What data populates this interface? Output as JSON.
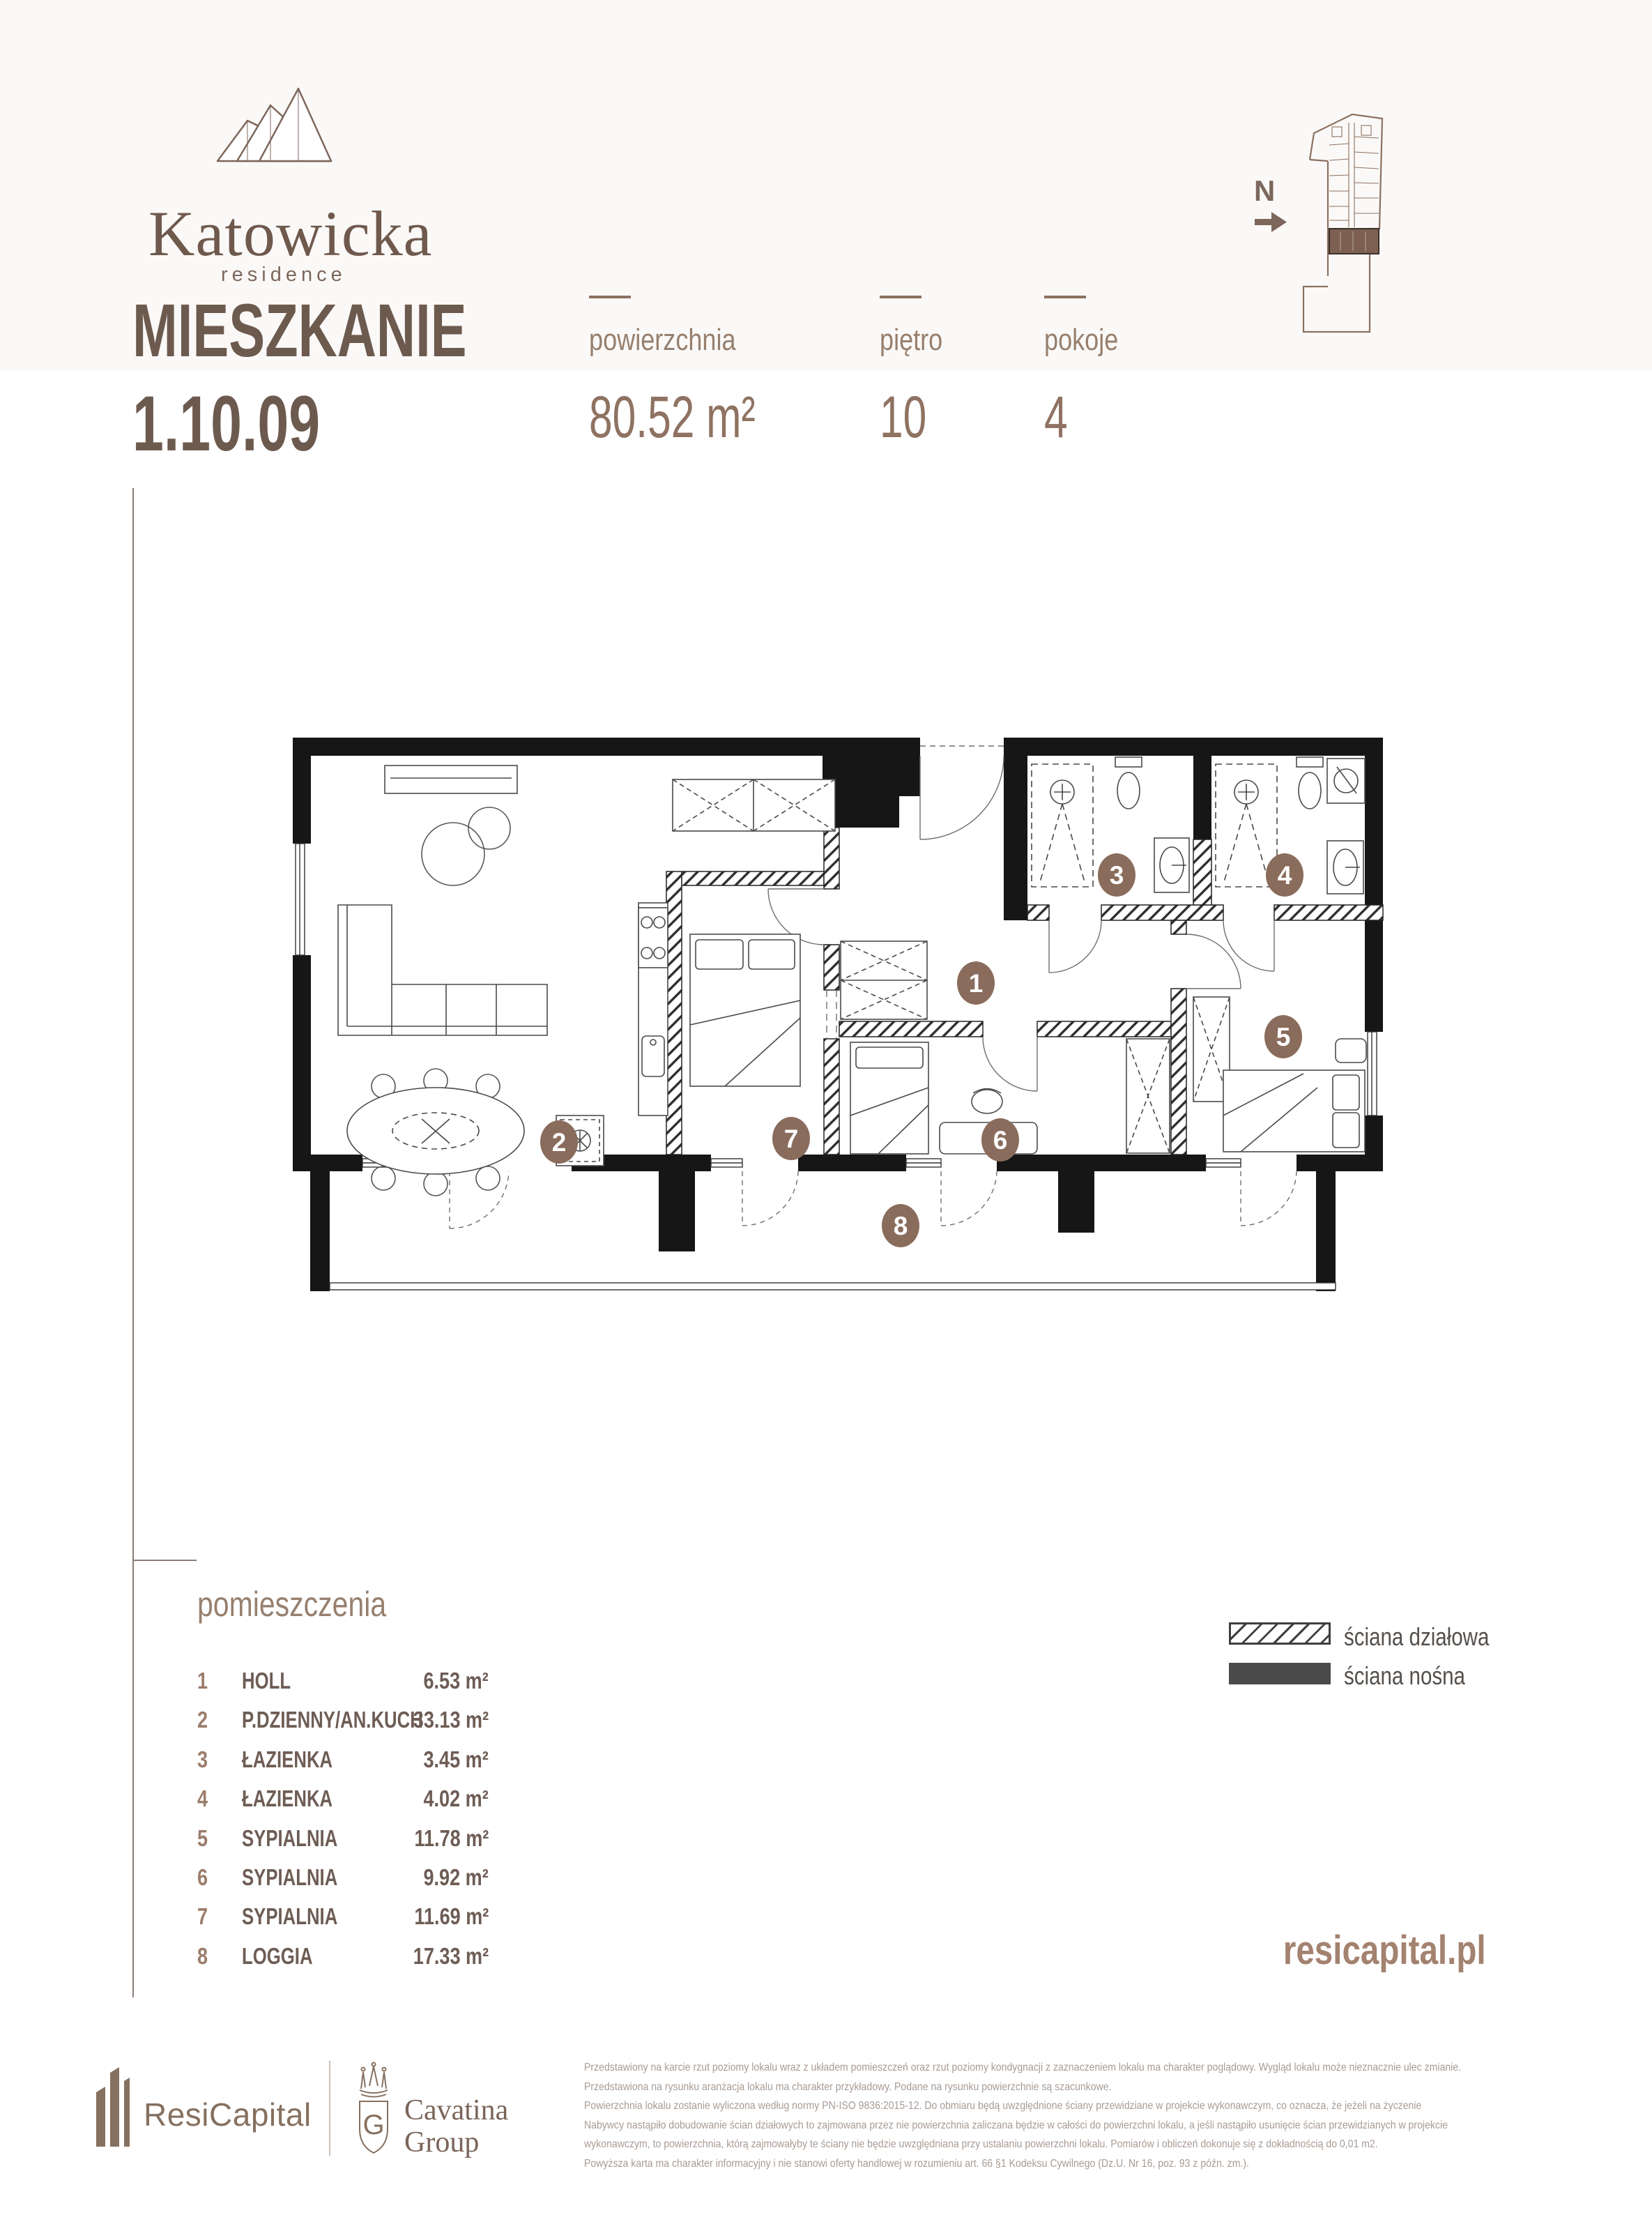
{
  "brand": {
    "name": "Katowicka",
    "subtitle": "residence"
  },
  "title": {
    "label": "MIESZKANIE",
    "number": "1.10.09"
  },
  "stats": {
    "area_label": "powierzchnia",
    "area_value": "80.52 m²",
    "floor_label": "piętro",
    "floor_value": "10",
    "rooms_label": "pokoje",
    "rooms_value": "4"
  },
  "compass": {
    "label": "N"
  },
  "plan": {
    "badges": [
      "1",
      "2",
      "3",
      "4",
      "5",
      "6",
      "7",
      "8"
    ]
  },
  "room_list": {
    "heading": "pomieszczenia",
    "items": [
      {
        "no": "1",
        "name": "HOLL",
        "area": "6.53 m²"
      },
      {
        "no": "2",
        "name": "P.DZIENNY/AN.KUCH",
        "area": "33.13 m²"
      },
      {
        "no": "3",
        "name": "ŁAZIENKA",
        "area": "3.45 m²"
      },
      {
        "no": "4",
        "name": "ŁAZIENKA",
        "area": "4.02 m²"
      },
      {
        "no": "5",
        "name": "SYPIALNIA",
        "area": "11.78 m²"
      },
      {
        "no": "6",
        "name": "SYPIALNIA",
        "area": "9.92 m²"
      },
      {
        "no": "7",
        "name": "SYPIALNIA",
        "area": "11.69 m²"
      },
      {
        "no": "8",
        "name": "LOGGIA",
        "area": "17.33 m²"
      }
    ]
  },
  "legend": {
    "partition_label": "ściana działowa",
    "load_bearing_label": "ściana nośna"
  },
  "website": "resicapital.pl",
  "footer": {
    "resicapital_label": "ResiCapital",
    "cavatina_line1": "Cavatina",
    "cavatina_line2": "Group",
    "disclaimer": [
      "Przedstawiony na karcie rzut poziomy lokalu wraz z układem pomieszczeń oraz rzut poziomy kondygnacji z zaznaczeniem lokalu ma charakter poglądowy. Wygląd lokalu może nieznacznie ulec zmianie.",
      "Przedstawiona na rysunku aranżacja lokalu ma charakter przykładowy. Podane na rysunku powierzchnie są szacunkowe.",
      "Powierzchnia lokalu zostanie wyliczona według normy PN-ISO 9836:2015-12. Do obmiaru będą uwzględnione ściany przewidziane w projekcie wykonawczym, co oznacza, że jeżeli na życzenie",
      "Nabywcy nastąpiło dobudowanie ścian działowych to zajmowana przez nie powierzchnia zaliczana będzie w całości do powierzchni lokalu, a jeśli nastąpiło usunięcie ścian przewidzianych w projekcie",
      "wykonawczym, to powierzchnia, którą zajmowałyby te ściany nie będzie uwzględniana przy ustalaniu powierzchni lokalu. Pomiarów i obliczeń dokonuje się z dokładnością do 0,01 m2.",
      "Powyższa karta ma charakter informacyjny i nie stanowi oferty handlowej w rozumieniu art. 66 §1 Kodeksu Cywilnego (Dz.U. Nr 16, poz. 93 z późn. zm.)."
    ]
  },
  "colors": {
    "accent": "#8d7160",
    "title": "#6d5a4f",
    "wall": "#161616",
    "badge": "#8a6c5c"
  }
}
